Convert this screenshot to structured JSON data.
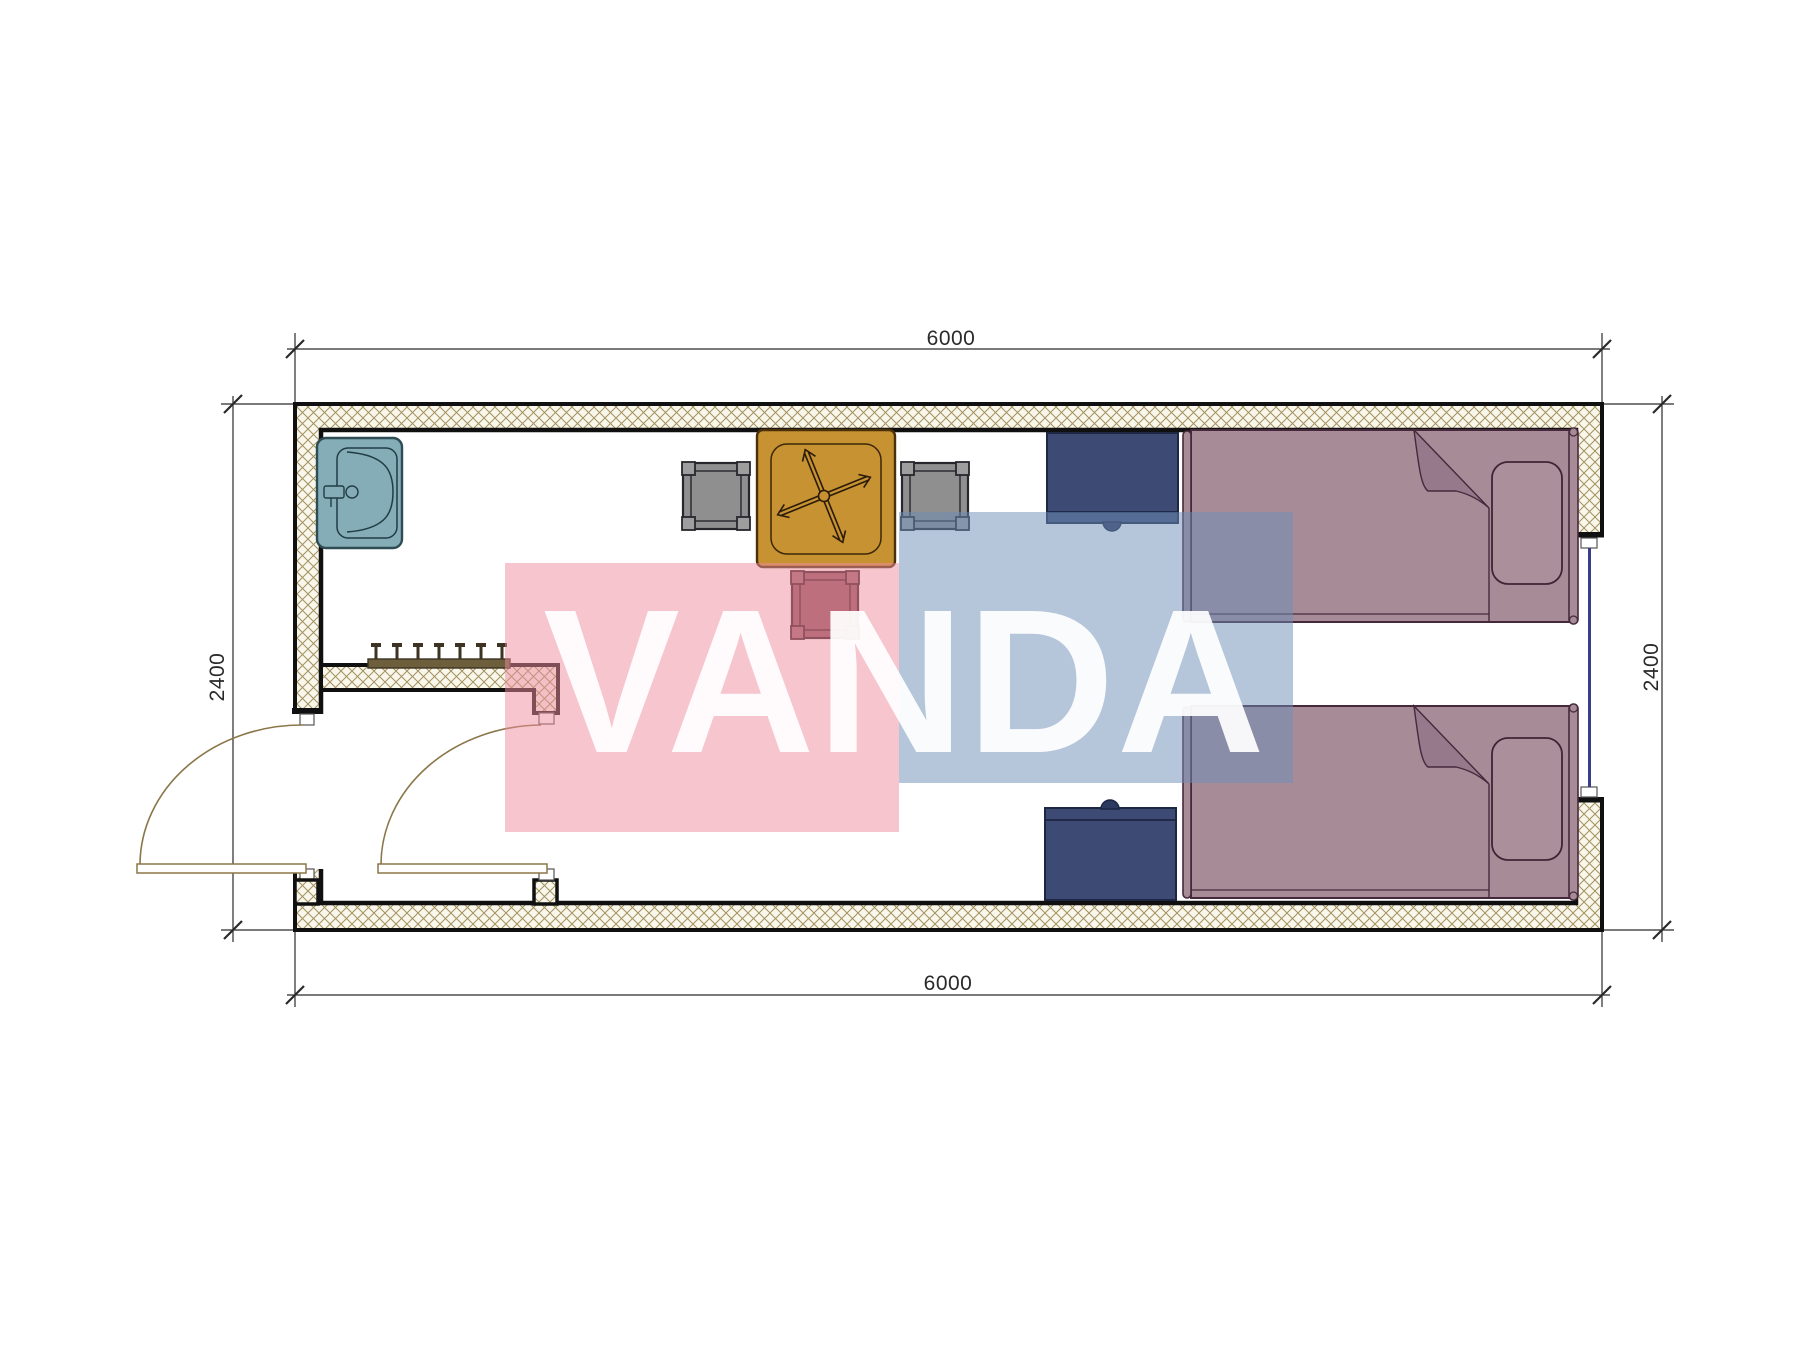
{
  "drawing": {
    "type": "floor-plan",
    "room_width_label": "6000",
    "room_depth_label": "2400"
  },
  "dimensions": {
    "top": "6000",
    "bottom": "6000",
    "left": "2400",
    "right": "2400"
  },
  "watermark": {
    "text": "VANDA",
    "pink_color": "rgba(237,139,157,0.5)",
    "blue_color": "rgba(110,142,182,0.5)",
    "text_color": "rgba(255,255,255,0.93)"
  },
  "colors": {
    "wall_hatch_line": "#a3925e",
    "wall_fill": "#f9f6ec",
    "wall_outline": "#101010",
    "sink_fill": "#84adb8",
    "sink_stroke": "#2e4c54",
    "table_fill": "#c69232",
    "table_stroke": "#4a3008",
    "stool_gray": "#8f8f8f",
    "stool_maroon": "#8f525c",
    "desk_fill": "#3c4a74",
    "desk_stroke": "#1d2642",
    "bed_fill": "#a78c98",
    "bed_stroke": "#46283c",
    "bed_fold_fill": "#96798a",
    "door_line": "#8a7648",
    "dimension_line": "#2a2a2a",
    "window_line": "#3c3c8c"
  },
  "furniture": {
    "items": [
      "sink",
      "coat-hooks",
      "table",
      "fan",
      "stool",
      "stool",
      "stool",
      "desk",
      "desk",
      "bed",
      "bed",
      "window",
      "door",
      "door"
    ]
  }
}
